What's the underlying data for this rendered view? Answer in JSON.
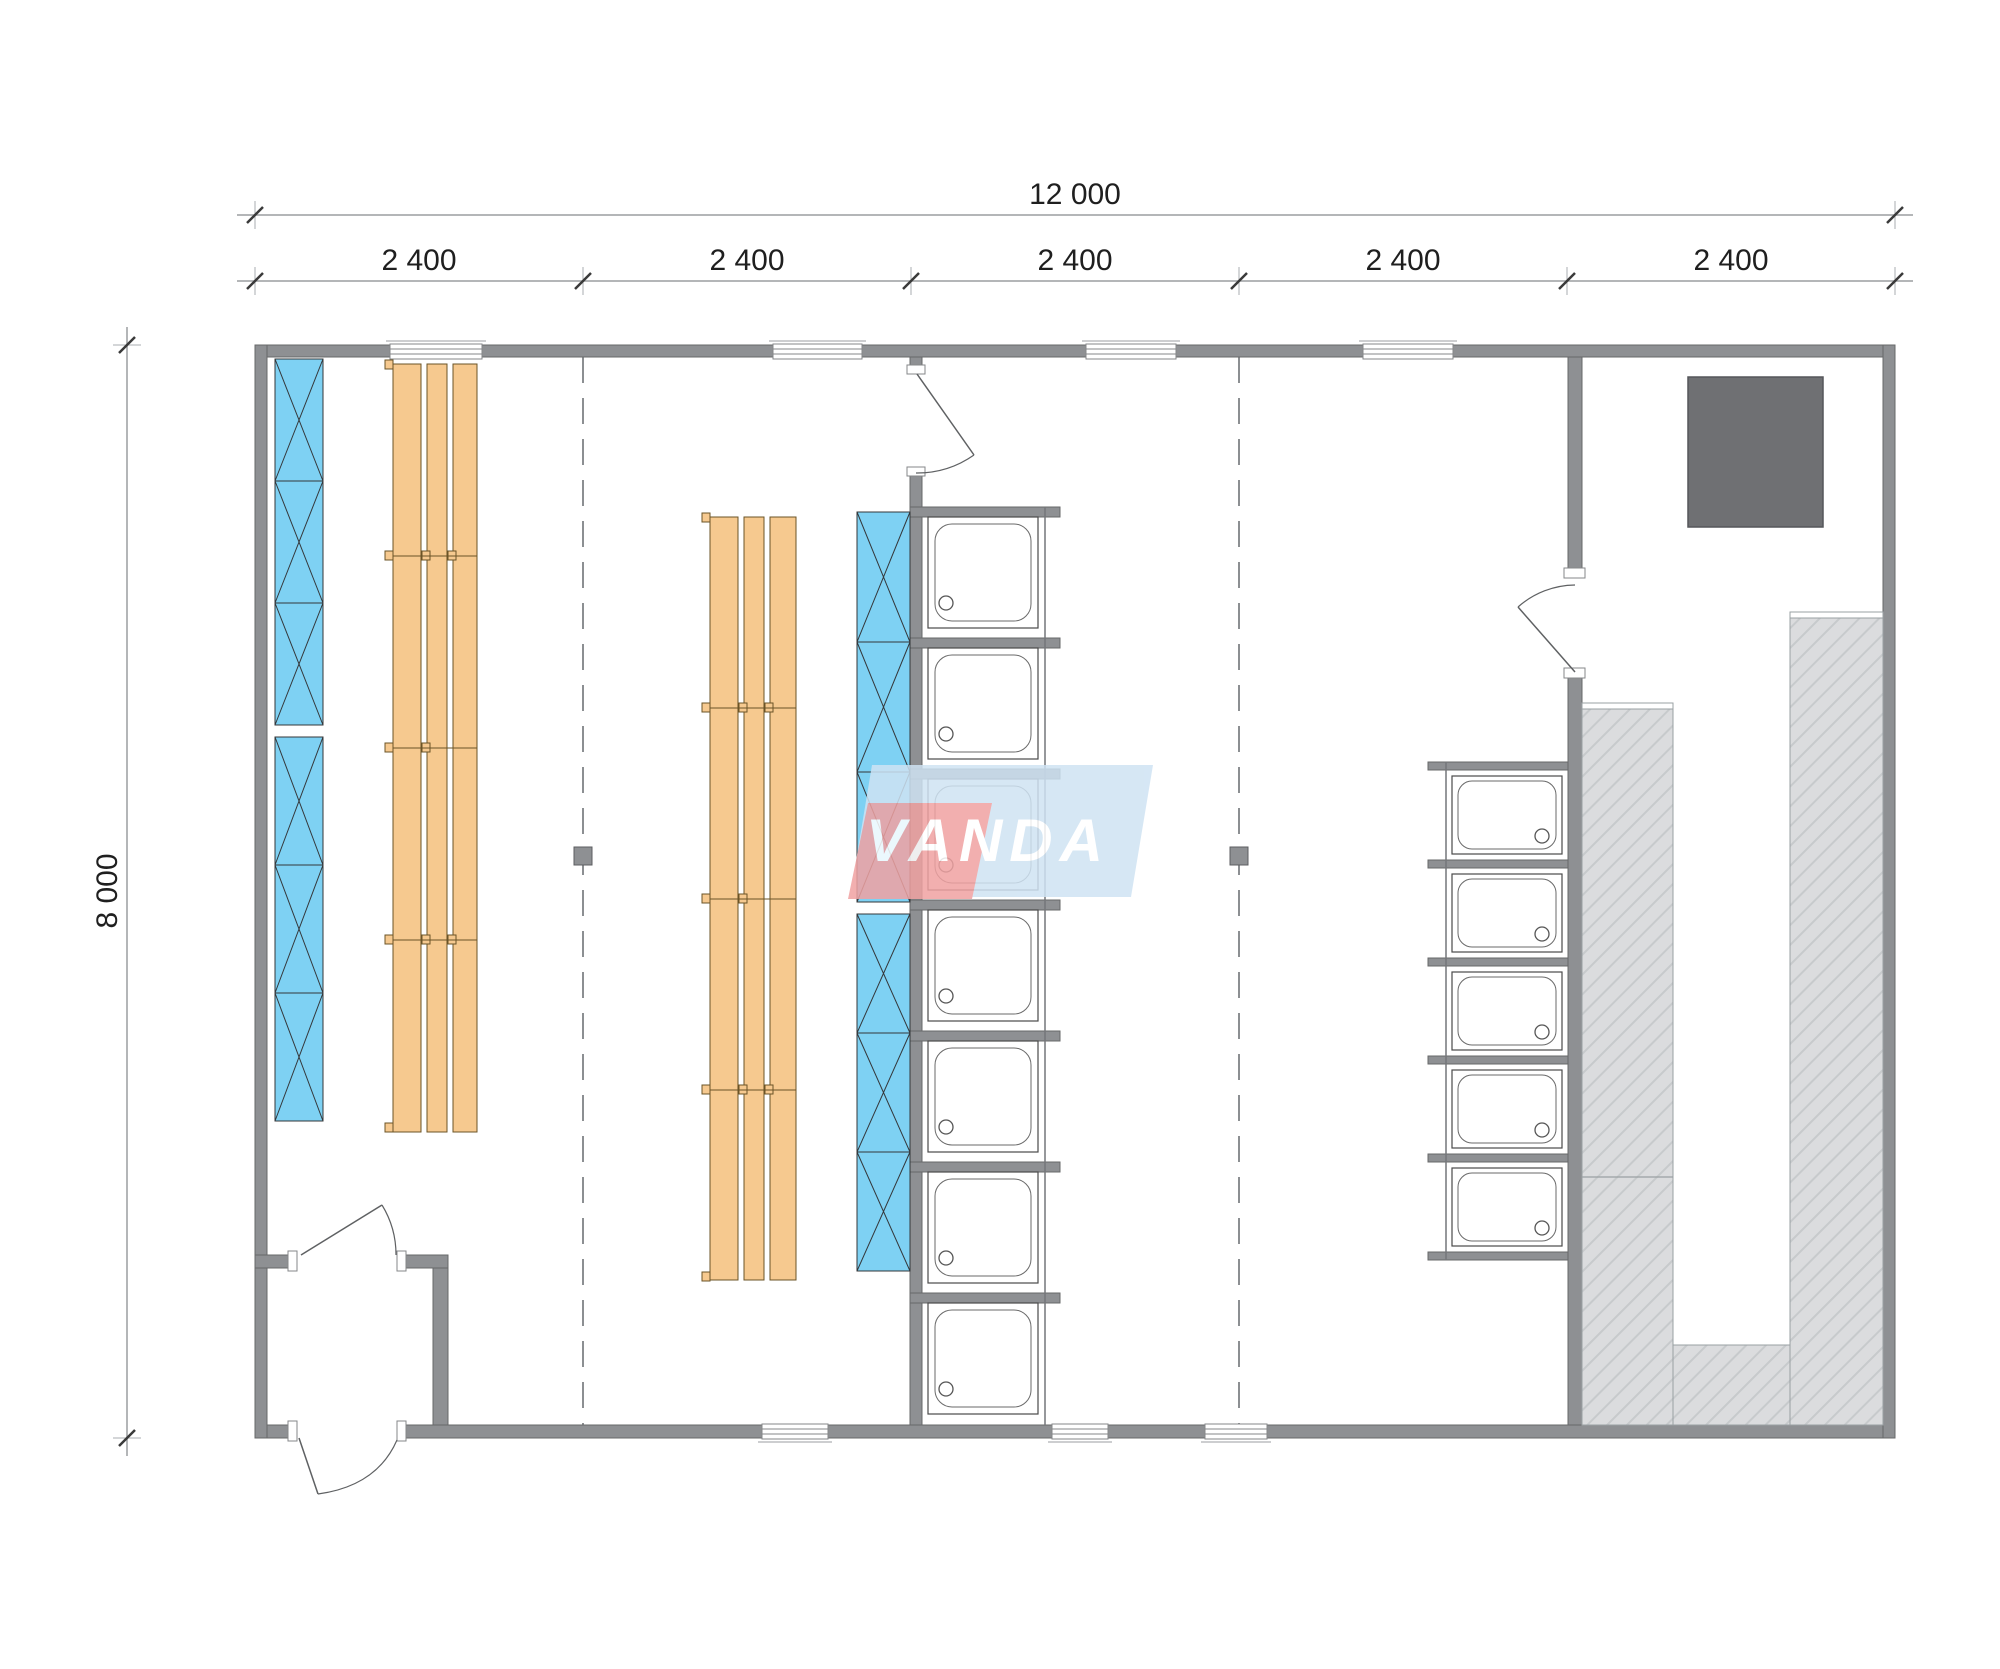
{
  "drawing": {
    "type": "floor-plan",
    "logo": {
      "text": "VANDA",
      "red_color": "#f0a2a2",
      "blue_color": "#cfe3f3"
    },
    "dimensions": {
      "total_width_label": "12 000",
      "height_label": "8 000",
      "bays": [
        "2 400",
        "2 400",
        "2 400",
        "2 400",
        "2 400"
      ]
    },
    "colors": {
      "wall": "#8e9093",
      "wall_edge": "#67686a",
      "locker_blue": "#7ed1f3",
      "bench_orange": "#f6c98f",
      "hatch_fill": "#dbdcde",
      "hatch_line": "#c7cacc",
      "heater_gray": "#6f7073",
      "dimension_line": "#9b9ea1",
      "dimension_text": "#1f1f1f"
    },
    "fixtures": {
      "left_locker_boxes": 6,
      "middle_locker_boxes": 6,
      "middle_shower_trays": 7,
      "right_shower_trays": 5,
      "bench_runs": 2,
      "bench_slats_per_run": 3,
      "sauna_heater_count": 1,
      "doors": 4,
      "top_windows": 4,
      "bottom_windows": 3
    }
  }
}
